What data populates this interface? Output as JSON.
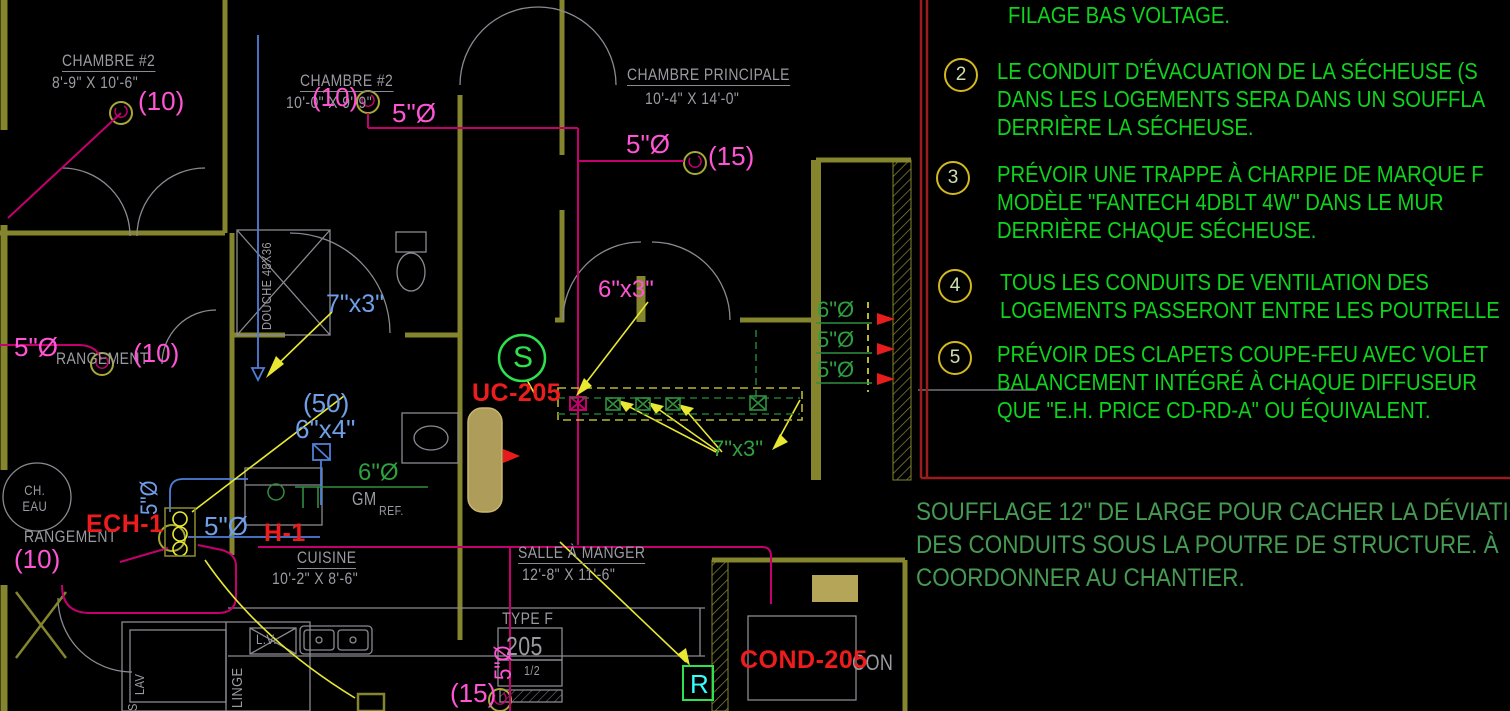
{
  "drawing": {
    "rooms": {
      "chambre2a": {
        "name": "CHAMBRE #2",
        "dims": "8'-9\" X 10'-6\""
      },
      "chambre2b": {
        "name": "CHAMBRE #2",
        "dims": "10'-0\" X 9'-9\""
      },
      "principale": {
        "name": "CHAMBRE PRINCIPALE",
        "dims": "10'-4\" X 14'-0\""
      },
      "cuisine": {
        "name": "CUISINE",
        "dims": "10'-2\" X 8'-6\""
      },
      "salle_a_manger": {
        "name": "SALLE À MANGER",
        "dims": "12'-8\" X 11'-6\""
      },
      "rangement_haut": "RANGEMENT",
      "rangement_bas": "RANGEMENT",
      "chauffe_eau": "CH. EAU",
      "douche": "DOUCHE 48X36"
    },
    "fixtures": {
      "lave_vaisselle": "L.V.",
      "laveuse": "LAV",
      "linge": "LINGE",
      "secheuse": "S",
      "gaz": "GM",
      "refrigerateur": "REF.",
      "type_f": "TYPE F",
      "tag_205": "205",
      "tag_demi": "1/2",
      "salon_partial": "CON"
    },
    "duct_labels": {
      "m10_a": "(10)",
      "m10_b": "(10)",
      "m10_c": "(10)",
      "m10_d": "(10)",
      "m15_a": "(15)",
      "m15_b": "(15)",
      "m5dia_a": "5\"Ø",
      "m5dia_b": "5\"Ø",
      "m5dia_c": "5\"Ø",
      "m5dia_riser": "5\"Ø",
      "m6x3": "6\"x3\"",
      "b7x3": "7\"x3\"",
      "b50": "(50)",
      "b6x4": "6\"x4\"",
      "b5dia_h": "5\"Ø",
      "b5dia_v": "5\"Ø",
      "g6dia": "6\"Ø",
      "g5dia_1": "5\"Ø",
      "g5dia_2": "5\"Ø",
      "g7x3": "7\"x3\"",
      "g6dia_gm": "6\"Ø"
    },
    "equipment_tags": {
      "uc": "UC-205",
      "ech": "ECH-1",
      "h": "H-1",
      "cond": "COND-205"
    },
    "symbols": {
      "supply": "S",
      "return": "R"
    }
  },
  "notes": {
    "intro": "FILAGE BAS VOLTAGE.",
    "items": [
      {
        "num": "2",
        "lines": [
          "LE CONDUIT D'ÉVACUATION DE LA SÉCHEUSE (S",
          "DANS LES LOGEMENTS SERA DANS UN SOUFFLA",
          "DERRIÈRE LA SÉCHEUSE."
        ]
      },
      {
        "num": "3",
        "lines": [
          "PRÉVOIR UNE TRAPPE À CHARPIE DE MARQUE F",
          "MODÈLE \"FANTECH 4DBLT 4W\" DANS LE MUR",
          "DERRIÈRE CHAQUE SÉCHEUSE."
        ]
      },
      {
        "num": "4",
        "lines": [
          "TOUS LES CONDUITS DE VENTILATION DES",
          "LOGEMENTS PASSERONT ENTRE LES POUTRELLE"
        ]
      },
      {
        "num": "5",
        "lines": [
          "PRÉVOIR DES CLAPETS COUPE-FEU AVEC VOLET",
          "BALANCEMENT INTÉGRÉ À CHAQUE DIFFUSEUR",
          "QUE \"E.H. PRICE CD-RD-A\" OU ÉQUIVALENT."
        ]
      }
    ]
  },
  "soufflage_note": {
    "lines": [
      "SOUFFLAGE 12\" DE LARGE POUR CACHER LA DÉVIATION",
      "DES CONDUITS SOUS LA POUTRE DE STRUCTURE. À",
      "COORDONNER AU CHANTIER."
    ]
  },
  "colors": {
    "background": "#000000",
    "wall_olive": "#85852e",
    "duct_magenta": "#c4006e",
    "label_magenta": "#ff55d5",
    "label_blue": "#6f9fe8",
    "duct_green": "#2f8f3f",
    "note_green": "#0fd41e",
    "soufflage_green": "#479a52",
    "tag_red": "#ee1c1c",
    "leader_yellow": "#e8e832",
    "border_red": "#9b1c1c",
    "symbol_cyan": "#35ffff"
  }
}
